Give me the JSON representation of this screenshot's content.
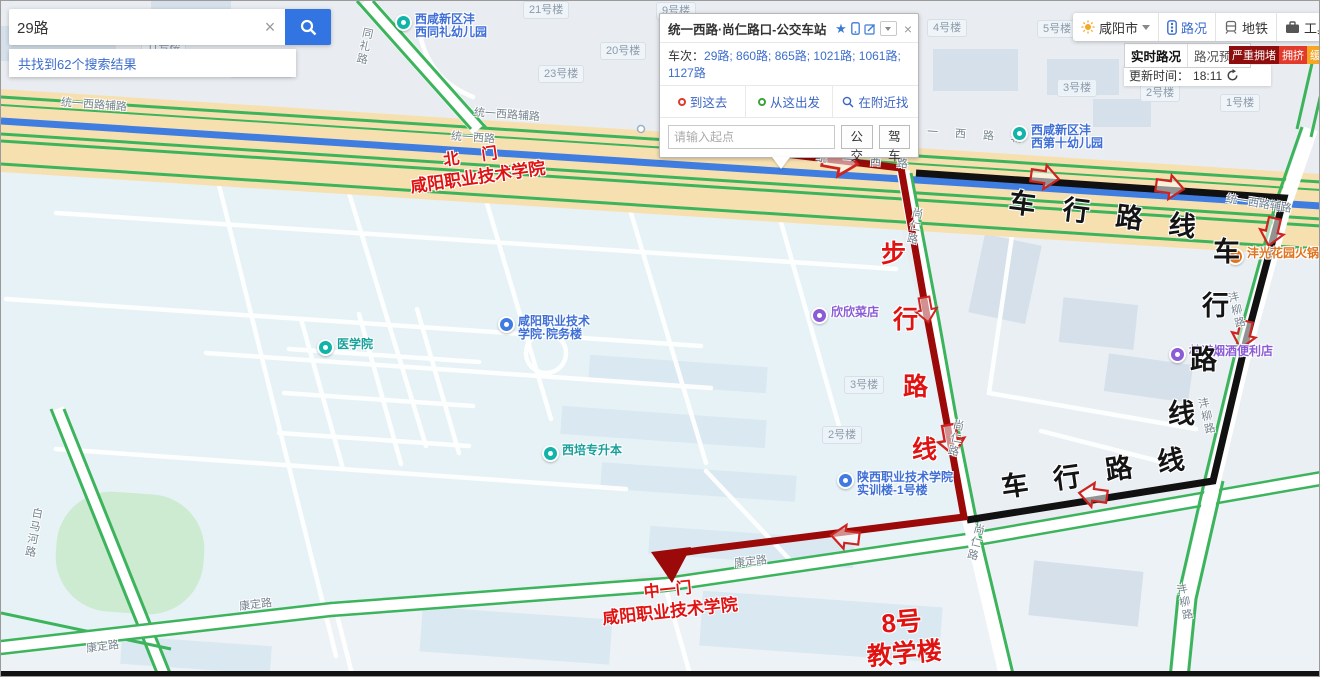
{
  "search": {
    "query": "29路",
    "results_text": "共找到62个搜索结果"
  },
  "popup": {
    "title": "统一西路·尚仁路口-公交车站",
    "routes_label": "车次：",
    "routes": "29路; 860路; 865路; 1021路; 1061路; 1127路",
    "tabs": [
      "到这去",
      "从这出发",
      "在附近找"
    ],
    "origin_placeholder": "请输入起点",
    "transit_button": "公交",
    "drive_button": "驾车"
  },
  "toolbar": {
    "city": "咸阳市",
    "traffic": "路况",
    "metro": "地铁",
    "toolbox": "工具箱"
  },
  "traffic_panel": {
    "tab_realtime": "实时路况",
    "tab_forecast": "路况预测",
    "legend": [
      {
        "label": "严重拥堵",
        "color": "#8e0e0e"
      },
      {
        "label": "拥挤",
        "color": "#e23a2b"
      },
      {
        "label": "缓行",
        "color": "#f5a623"
      },
      {
        "label": "畅通",
        "color": "#45a93c"
      }
    ],
    "update_label": "更新时间：",
    "update_time": "18:11"
  },
  "annotations": {
    "north_gate": {
      "line1": "北  门",
      "line2": "咸阳职业技术学院"
    },
    "middle_gate": {
      "line1": "中一门",
      "line2": "咸阳职业技术学院"
    },
    "building8": {
      "line1": "8号",
      "line2": "教学楼"
    },
    "walk": [
      "步",
      "行",
      "路",
      "线"
    ],
    "drive": [
      "车",
      "行",
      "路",
      "线"
    ]
  },
  "map": {
    "roads": {
      "tongli": "同礼路",
      "fulu": "统一西路辅路",
      "main": "统一西路",
      "shangren": "尚仁路",
      "fengliu": "沣柳路",
      "kangding": "康定路",
      "baimahe": "白马河路"
    },
    "buildings": [
      "11号楼",
      "21号楼",
      "9号楼",
      "20号楼",
      "23号楼",
      "4号楼",
      "5号楼",
      "3号楼",
      "2号楼",
      "1号楼",
      "3号楼",
      "2号楼"
    ],
    "pois": {
      "kg1": {
        "line1": "西咸新区沣",
        "line2": "西同礼幼儿园"
      },
      "kg2": {
        "line1": "西咸新区沣",
        "line2": "西第十幼儿园"
      },
      "med": {
        "name": "医学院"
      },
      "yuanwu": {
        "line1": "咸阳职业技术",
        "line2": "学院·院务楼"
      },
      "xipei": {
        "name": "西培专升本"
      },
      "xinxin": {
        "name": "欣欣菜店"
      },
      "shixun": {
        "line1": "陕西职业技术学院",
        "line2": "实训楼-1号楼"
      },
      "hotpot": {
        "name": "沣光花园火锅店"
      },
      "conv": {
        "name": "林诺烟酒便利店"
      }
    },
    "colors": {
      "walk_route": "#9b0909",
      "drive_route": "#111111",
      "bus_road": "#3f7de0",
      "traffic_smooth": "#3cb45c",
      "annotation_red": "#e01212"
    }
  }
}
